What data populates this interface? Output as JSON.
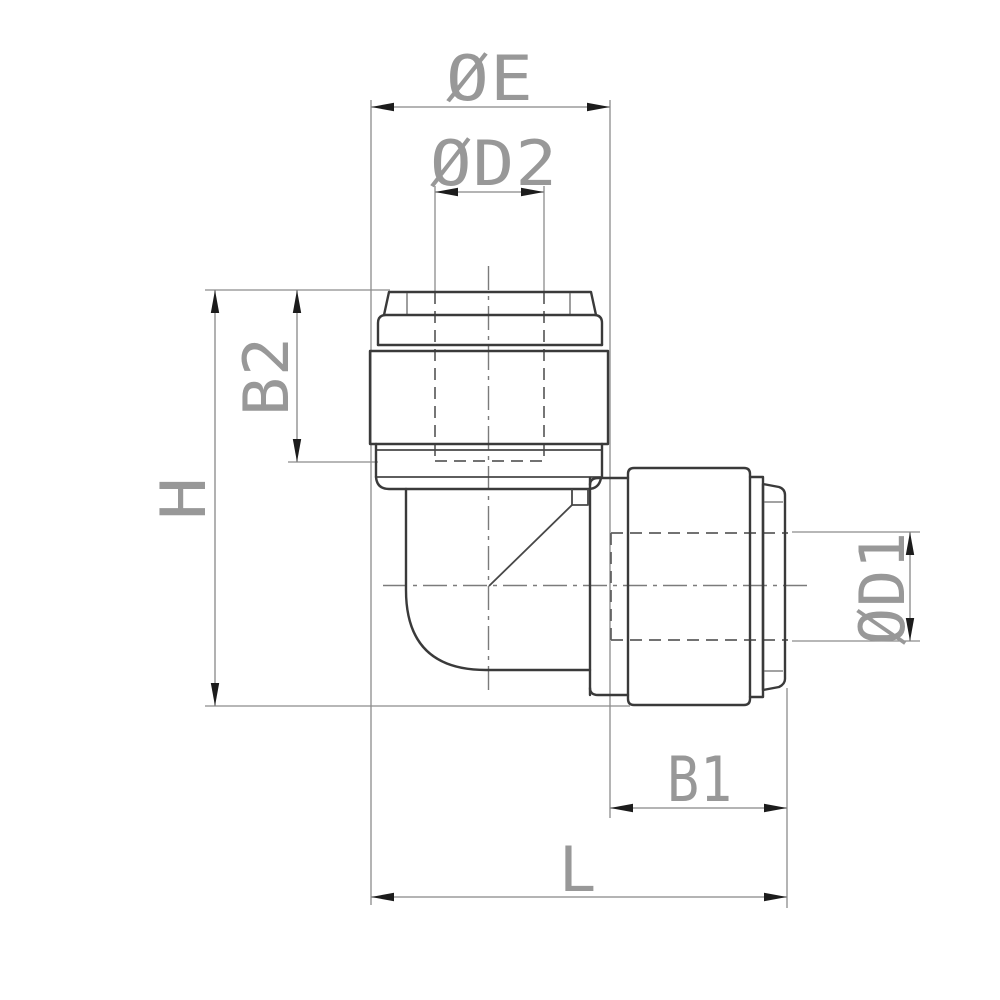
{
  "drawing": {
    "kind": "engineering-drawing",
    "subject": "90-degree elbow push-in tube fitting, orthographic side view",
    "background_color": "#ffffff",
    "colors": {
      "outline": "#3a3a3a",
      "thin_line": "#8c8c8c",
      "hidden_line": "#5e5e5e",
      "centerline": "#7b7b7b",
      "arrow": "#1c1c1c",
      "label_text": "#989898"
    },
    "dimensions": {
      "oe": {
        "label": "ØE"
      },
      "od2": {
        "label": "ØD2"
      },
      "b2": {
        "label": "B2"
      },
      "h": {
        "label": "H"
      },
      "od1": {
        "label": "ØD1"
      },
      "b1": {
        "label": "B1"
      },
      "l": {
        "label": "L"
      }
    }
  }
}
